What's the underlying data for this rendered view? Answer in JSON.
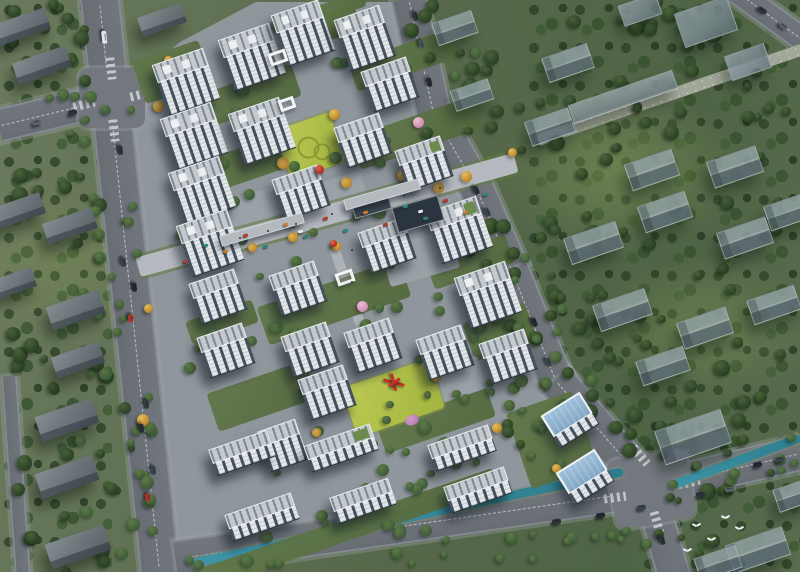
{
  "palette": {
    "context_grass": "#566849",
    "forest_dark": "#2b4026",
    "site_paving": "#8f969c",
    "road_asphalt": "#6d7378",
    "tower_wall": "#e3e7ea",
    "tower_glass": "#46525e",
    "roof_grey": "#c3c8cc",
    "roof_rib": "#79858f",
    "context_block": "#8b98a0",
    "lawn_bright": "#aebd46",
    "water_teal": "#3d95a6",
    "autumn_tree": "#c08c2e",
    "blossom_pink": "#cf8fb4",
    "accent_red": "#b8301f",
    "blue_roof": "#8fb4d4"
  },
  "scene": {
    "forest": [
      [
        0,
        0,
        112,
        572
      ],
      [
        525,
        0,
        275,
        460
      ],
      [
        640,
        440,
        160,
        132
      ]
    ],
    "site_polygon": [
      [
        112,
        98
      ],
      [
        180,
        42
      ],
      [
        256,
        2
      ],
      [
        402,
        2
      ],
      [
        440,
        128
      ],
      [
        520,
        290
      ],
      [
        648,
        478
      ],
      [
        556,
        496
      ],
      [
        360,
        522
      ],
      [
        232,
        540
      ],
      [
        174,
        548
      ]
    ],
    "roads": [
      [
        130,
        286,
        600,
        40,
        84,
        1
      ],
      [
        55,
        112,
        116,
        34,
        -13.6,
        1
      ],
      [
        422,
        58,
        122,
        36,
        77.8,
        1
      ],
      [
        455,
        150,
        84,
        36,
        60.3,
        1
      ],
      [
        494,
        228,
        94,
        36,
        66.5,
        1
      ],
      [
        534,
        325,
        120,
        36,
        68.2,
        1
      ],
      [
        603,
        434,
        144,
        38,
        48.7,
        1
      ],
      [
        415,
        524,
        484,
        36,
        -8.2,
        1
      ],
      [
        727,
        470,
        150,
        36,
        -13,
        1
      ],
      [
        661,
        532,
        95,
        34,
        74,
        0
      ],
      [
        770,
        16,
        85,
        26,
        36,
        1
      ],
      [
        16,
        476,
        200,
        16,
        86,
        0
      ]
    ],
    "intersections": [
      [
        112,
        98,
        66,
        60,
        0
      ],
      [
        651,
        489,
        80,
        70,
        -10
      ]
    ],
    "crossings": [
      [
        111,
        68,
        22,
        9,
        84
      ],
      [
        114,
        130,
        22,
        9,
        84
      ],
      [
        84,
        104,
        22,
        9,
        -14
      ],
      [
        141,
        94,
        22,
        9,
        -14
      ],
      [
        640,
        455,
        22,
        9,
        49
      ],
      [
        657,
        522,
        22,
        9,
        74
      ],
      [
        615,
        497,
        22,
        9,
        -8
      ],
      [
        689,
        482,
        22,
        9,
        -13
      ]
    ],
    "canal": [
      [
        408,
        517,
        440,
        9,
        -12
      ],
      [
        736,
        461,
        136,
        9,
        -20.4
      ]
    ],
    "paths": [
      [
        670,
        95,
        280,
        12,
        -19,
        "pebble"
      ],
      [
        352,
        300,
        112,
        10,
        71,
        "walk"
      ]
    ],
    "street": [
      327,
      215,
      392,
      20,
      -15.5
    ],
    "lawns": [
      [
        310,
        146,
        58,
        52,
        -19,
        1
      ],
      [
        393,
        398,
        92,
        52,
        -19,
        0
      ]
    ],
    "courtyards": [
      [
        172,
        72,
        70,
        44
      ],
      [
        234,
        101,
        132,
        34
      ],
      [
        245,
        164,
        138,
        34
      ],
      [
        320,
        30,
        80,
        26
      ],
      [
        404,
        60,
        108,
        30
      ],
      [
        416,
        133,
        128,
        34
      ],
      [
        334,
        302,
        150,
        40
      ],
      [
        262,
        396,
        104,
        40
      ],
      [
        436,
        420,
        116,
        32
      ],
      [
        500,
        332,
        66,
        40
      ],
      [
        222,
        322,
        70,
        24
      ],
      [
        470,
        262,
        84,
        30
      ],
      [
        336,
        8,
        60,
        16
      ],
      [
        552,
        440,
        70,
        80
      ],
      [
        340,
        532,
        330,
        22
      ]
    ],
    "plazas": [
      [
        238,
        222,
        84,
        48,
        -16
      ],
      [
        338,
        196,
        56,
        36,
        -16
      ],
      [
        420,
        258,
        72,
        40,
        -16
      ],
      [
        452,
        382,
        64,
        34,
        -19
      ]
    ],
    "podiums": [
      [
        418,
        214,
        48,
        26,
        "#2b3540"
      ],
      [
        372,
        207,
        38,
        13,
        "#3b444e"
      ],
      [
        262,
        229,
        86,
        11,
        "#b4b9be"
      ],
      [
        382,
        194,
        78,
        11,
        "#b4b9be"
      ]
    ],
    "kinds": {
      "t": {
        "w": 54,
        "d": 20,
        "fh": 34
      },
      "m": {
        "w": 48,
        "d": 17,
        "fh": 26
      },
      "l": {
        "w": 62,
        "d": 16,
        "fh": 12
      },
      "b": {
        "w": 46,
        "d": 26,
        "fh": 12
      }
    },
    "buildings": [
      {
        "x": 186,
        "y": 82,
        "k": "t"
      },
      {
        "x": 194,
        "y": 136,
        "k": "t"
      },
      {
        "x": 202,
        "y": 190,
        "k": "t"
      },
      {
        "x": 210,
        "y": 243,
        "k": "t"
      },
      {
        "x": 252,
        "y": 57,
        "k": "t"
      },
      {
        "x": 262,
        "y": 131,
        "k": "t"
      },
      {
        "x": 303,
        "y": 33,
        "k": "t",
        "w": 50
      },
      {
        "x": 365,
        "y": 38,
        "k": "t",
        "w": 48
      },
      {
        "x": 459,
        "y": 230,
        "k": "t",
        "g": 1
      },
      {
        "x": 488,
        "y": 295,
        "k": "t"
      },
      {
        "x": 390,
        "y": 84,
        "k": "m"
      },
      {
        "x": 363,
        "y": 140,
        "k": "m"
      },
      {
        "x": 301,
        "y": 192,
        "k": "m"
      },
      {
        "x": 424,
        "y": 163,
        "k": "m",
        "g": 1
      },
      {
        "x": 298,
        "y": 288,
        "k": "m"
      },
      {
        "x": 387,
        "y": 245,
        "k": "m"
      },
      {
        "x": 218,
        "y": 296,
        "k": "m"
      },
      {
        "x": 226,
        "y": 350,
        "k": "m"
      },
      {
        "x": 310,
        "y": 349,
        "k": "m"
      },
      {
        "x": 373,
        "y": 345,
        "k": "m"
      },
      {
        "x": 445,
        "y": 352,
        "k": "m"
      },
      {
        "x": 508,
        "y": 356,
        "k": "m"
      },
      {
        "x": 327,
        "y": 392,
        "k": "m"
      },
      {
        "x": 283,
        "y": 445,
        "k": "m",
        "w": 40
      },
      {
        "x": 341,
        "y": 448,
        "k": "l",
        "w": 70,
        "g": 1
      },
      {
        "x": 462,
        "y": 448,
        "k": "l",
        "w": 64
      },
      {
        "x": 242,
        "y": 453,
        "k": "l",
        "w": 62
      },
      {
        "x": 262,
        "y": 517,
        "k": "l",
        "w": 70
      },
      {
        "x": 363,
        "y": 501,
        "k": "l",
        "w": 62
      },
      {
        "x": 478,
        "y": 490,
        "k": "l",
        "w": 64
      },
      {
        "x": 570,
        "y": 420,
        "k": "b",
        "rot": -32
      },
      {
        "x": 585,
        "y": 477,
        "k": "b",
        "rot": -32
      }
    ],
    "gates": [
      [
        278,
        57,
        18,
        13
      ],
      [
        287,
        104,
        16,
        12
      ],
      [
        345,
        277,
        18,
        13
      ]
    ],
    "context": [
      [
        21,
        27,
        56,
        22,
        -19,
        "s"
      ],
      [
        42,
        65,
        56,
        22,
        -19,
        "s"
      ],
      [
        162,
        20,
        46,
        20,
        -19,
        "s"
      ],
      [
        18,
        211,
        52,
        22,
        -19,
        "s"
      ],
      [
        70,
        226,
        52,
        22,
        -19,
        "s"
      ],
      [
        75,
        310,
        55,
        24,
        -19,
        "s"
      ],
      [
        15,
        283,
        40,
        20,
        -19,
        "s"
      ],
      [
        78,
        360,
        50,
        22,
        -19,
        "s"
      ],
      [
        67,
        420,
        60,
        26,
        -19,
        "s"
      ],
      [
        67,
        477,
        60,
        26,
        -19,
        "s"
      ],
      [
        78,
        547,
        62,
        26,
        -19,
        "s"
      ],
      [
        706,
        22,
        56,
        36,
        -19,
        "t"
      ],
      [
        748,
        62,
        42,
        26,
        -19,
        "t"
      ],
      [
        640,
        10,
        40,
        22,
        -19,
        "t"
      ],
      [
        623,
        97,
        110,
        20,
        -19,
        "L"
      ],
      [
        568,
        63,
        48,
        26,
        -19,
        "g"
      ],
      [
        550,
        127,
        46,
        26,
        -19,
        "g"
      ],
      [
        652,
        170,
        50,
        28,
        -19,
        "g"
      ],
      [
        735,
        167,
        52,
        28,
        -19,
        "g"
      ],
      [
        788,
        212,
        44,
        26,
        -19,
        "g"
      ],
      [
        593,
        243,
        55,
        28,
        -19,
        "g"
      ],
      [
        665,
        212,
        50,
        28,
        -19,
        "g"
      ],
      [
        745,
        238,
        52,
        28,
        -19,
        "g"
      ],
      [
        622,
        310,
        55,
        28,
        -19,
        "g"
      ],
      [
        705,
        328,
        52,
        28,
        -19,
        "g"
      ],
      [
        663,
        366,
        50,
        26,
        -19,
        "g"
      ],
      [
        774,
        305,
        50,
        26,
        -19,
        "g"
      ],
      [
        455,
        28,
        42,
        24,
        -19,
        "g"
      ],
      [
        472,
        95,
        40,
        22,
        -19,
        "g"
      ],
      [
        693,
        437,
        70,
        36,
        -19,
        "g"
      ],
      [
        758,
        550,
        60,
        30,
        -19,
        "g"
      ],
      [
        795,
        495,
        40,
        24,
        -19,
        "g"
      ],
      [
        718,
        563,
        44,
        24,
        -19,
        "g"
      ]
    ],
    "tree_zones": [
      [
        0,
        0,
        95,
        95,
        12,
        "d"
      ],
      [
        0,
        140,
        110,
        250,
        18,
        "d"
      ],
      [
        0,
        390,
        140,
        182,
        18,
        "d"
      ],
      [
        112,
        95,
        42,
        465,
        22,
        "m"
      ],
      [
        80,
        95,
        28,
        455,
        14,
        "m"
      ],
      [
        0,
        95,
        108,
        48,
        8,
        "m"
      ],
      [
        408,
        0,
        120,
        150,
        14,
        "d"
      ],
      [
        455,
        130,
        110,
        180,
        16,
        "d"
      ],
      [
        505,
        280,
        120,
        170,
        16,
        "d"
      ],
      [
        595,
        400,
        95,
        110,
        10,
        "d"
      ],
      [
        540,
        0,
        260,
        110,
        20,
        "d"
      ],
      [
        555,
        100,
        245,
        160,
        24,
        "d"
      ],
      [
        575,
        250,
        225,
        170,
        20,
        "d"
      ],
      [
        650,
        420,
        150,
        150,
        16,
        "d"
      ],
      [
        180,
        515,
        470,
        52,
        26,
        "m"
      ],
      [
        655,
        428,
        145,
        62,
        10,
        "m"
      ],
      [
        148,
        88,
        115,
        170,
        10,
        "m"
      ],
      [
        228,
        112,
        155,
        120,
        8,
        "m"
      ],
      [
        278,
        232,
        175,
        112,
        12,
        "m"
      ],
      [
        348,
        292,
        175,
        118,
        10,
        "m"
      ],
      [
        248,
        378,
        195,
        112,
        12,
        "m"
      ],
      [
        418,
        378,
        145,
        92,
        9,
        "m"
      ],
      [
        438,
        238,
        95,
        112,
        7,
        "m"
      ],
      [
        478,
        298,
        85,
        92,
        7,
        "m"
      ],
      [
        298,
        438,
        225,
        82,
        10,
        "m"
      ],
      [
        188,
        252,
        92,
        122,
        8,
        "m"
      ],
      [
        358,
        52,
        135,
        122,
        8,
        "m"
      ],
      [
        252,
        0,
        145,
        70,
        7,
        "m"
      ],
      [
        515,
        375,
        90,
        85,
        7,
        "m"
      ]
    ],
    "yellow_trees": [
      [
        168,
        60
      ],
      [
        158,
        106
      ],
      [
        271,
        125
      ],
      [
        283,
        163
      ],
      [
        334,
        114
      ],
      [
        346,
        182
      ],
      [
        252,
        247
      ],
      [
        293,
        237
      ],
      [
        438,
        187
      ],
      [
        466,
        176
      ],
      [
        512,
        152
      ],
      [
        307,
        390
      ],
      [
        316,
        432
      ],
      [
        436,
        377
      ],
      [
        497,
        428
      ],
      [
        556,
        468
      ],
      [
        143,
        420
      ],
      [
        148,
        308
      ],
      [
        356,
        160
      ],
      [
        374,
        203
      ],
      [
        403,
        175
      ],
      [
        336,
        246
      ]
    ],
    "pink_trees": [
      [
        362,
        306
      ],
      [
        300,
        12
      ],
      [
        418,
        122
      ]
    ],
    "flowerbed": [
      412,
      420,
      14,
      10
    ],
    "spheres": [
      [
        319,
        169,
        9
      ],
      [
        333,
        243,
        7
      ]
    ],
    "branch_sculpture": [
      394,
      382
    ],
    "awnings": [
      [
        185,
        261,
        "#b43a2e"
      ],
      [
        205,
        245,
        "#2e8577"
      ],
      [
        225,
        251,
        "#c77f2e"
      ],
      [
        245,
        235,
        "#b43a2e"
      ],
      [
        265,
        246,
        "#2e8577"
      ],
      [
        285,
        224,
        "#c77f2e"
      ],
      [
        305,
        236,
        "#2e8577"
      ],
      [
        325,
        218,
        "#b43a2e"
      ],
      [
        345,
        230,
        "#2e8577"
      ],
      [
        365,
        212,
        "#c77f2e"
      ],
      [
        385,
        224,
        "#b43a2e"
      ],
      [
        405,
        206,
        "#2e8577"
      ],
      [
        425,
        218,
        "#2e8577"
      ],
      [
        445,
        200,
        "#b43a2e"
      ],
      [
        465,
        212,
        "#c77f2e"
      ],
      [
        485,
        194,
        "#2e8577"
      ],
      [
        300,
        231,
        "#e8e8e8"
      ],
      [
        420,
        211,
        "#e8e8e8"
      ]
    ],
    "people": [
      [
        240,
        238
      ],
      [
        268,
        231
      ],
      [
        296,
        224
      ],
      [
        332,
        214
      ],
      [
        368,
        205
      ],
      [
        404,
        196
      ],
      [
        440,
        188
      ],
      [
        352,
        250
      ],
      [
        352,
        282
      ]
    ],
    "cars": [
      [
        104,
        37,
        84,
        "#e2e6e8",
        13
      ],
      [
        120,
        150,
        84,
        "#2c3338",
        9
      ],
      [
        123,
        262,
        84,
        "#3a4146",
        9
      ],
      [
        134,
        287,
        84,
        "#23292e",
        9
      ],
      [
        131,
        318,
        84,
        "#b03428",
        8
      ],
      [
        146,
        404,
        84,
        "#333a40",
        9
      ],
      [
        141,
        428,
        84,
        "#272d33",
        9
      ],
      [
        153,
        470,
        84,
        "#3c444b",
        9
      ],
      [
        148,
        497,
        84,
        "#b03428",
        8
      ],
      [
        36,
        122,
        -14,
        "#596066",
        9
      ],
      [
        72,
        112,
        -14,
        "#2c3338",
        9
      ],
      [
        415,
        16,
        78,
        "#2c3338",
        9
      ],
      [
        421,
        44,
        78,
        "#4a5258",
        9
      ],
      [
        429,
        82,
        78,
        "#23292e",
        9
      ],
      [
        476,
        190,
        66,
        "#2c3338",
        9
      ],
      [
        487,
        212,
        66,
        "#3c444b",
        9
      ],
      [
        534,
        322,
        68,
        "#23292e",
        9
      ],
      [
        548,
        362,
        68,
        "#3c444b",
        9
      ],
      [
        556,
        521,
        -8,
        "#2c3338",
        9
      ],
      [
        600,
        515,
        -8,
        "#23292e",
        9
      ],
      [
        641,
        507,
        -8,
        "#3c444b",
        9
      ],
      [
        700,
        494,
        -8,
        "#2c3338",
        9
      ],
      [
        729,
        489,
        -8,
        "#596066",
        9
      ],
      [
        662,
        540,
        74,
        "#2c3338",
        9
      ],
      [
        757,
        464,
        -13,
        "#23292e",
        9
      ],
      [
        779,
        459,
        -13,
        "#3c444b",
        9
      ],
      [
        762,
        10,
        36,
        "#2c3338",
        9
      ],
      [
        783,
        26,
        36,
        "#596066",
        9
      ]
    ],
    "birds": [
      [
        696,
        524
      ],
      [
        711,
        538
      ],
      [
        725,
        516
      ],
      [
        687,
        549
      ],
      [
        739,
        527
      ]
    ]
  }
}
